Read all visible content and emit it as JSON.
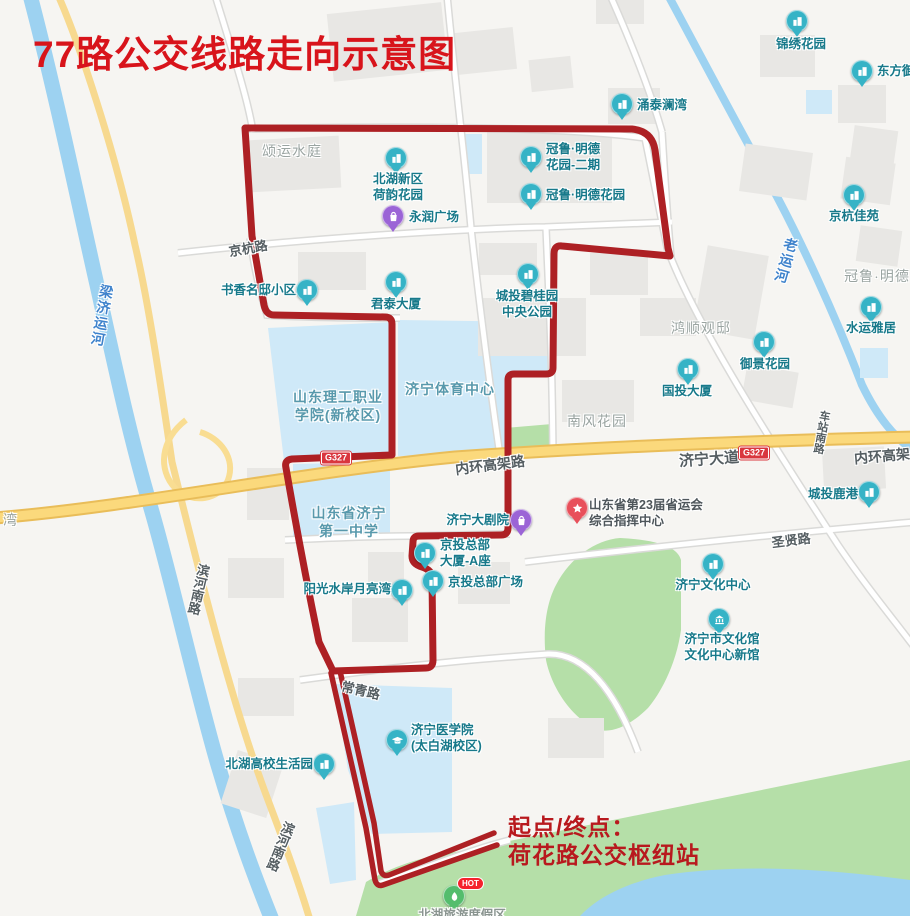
{
  "title": "77路公交线路走向示意图",
  "terminus": {
    "line1": "起点/终点：",
    "line2": "荷花路公交枢纽站"
  },
  "hot_badge": "HOT",
  "colors": {
    "route": "#ad2024",
    "title_red": "#d8141b",
    "terminus_red": "#b8191e",
    "poi_teal": "#36b3c6",
    "poi_purple": "#9b64d6",
    "poi_red": "#e8505b",
    "poi_green": "#54bd6d",
    "badge_red": "#d9363e",
    "water": "#9dd2f1",
    "campus_blue": "#cfe9f8",
    "park_green": "#b5dfa8",
    "road_yellow": "#fbd97c"
  },
  "badges": [
    {
      "text": "G327",
      "x": 336,
      "y": 458
    },
    {
      "text": "G327",
      "x": 754,
      "y": 453
    }
  ],
  "pois": [
    {
      "id": "jinxiu-huayuan",
      "glyph": "building",
      "color": "#36b3c6",
      "x": 797,
      "y": 21,
      "lx": 801,
      "ly": 36,
      "align": "center",
      "lines": [
        "锦绣花园"
      ]
    },
    {
      "id": "dongfang-yu",
      "glyph": "building",
      "color": "#36b3c6",
      "x": 862,
      "y": 71,
      "lx": 877,
      "ly": 63,
      "align": "left",
      "lines": [
        "东方御"
      ]
    },
    {
      "id": "yongtai-lanwan",
      "glyph": "building",
      "color": "#36b3c6",
      "x": 622,
      "y": 104,
      "lx": 637,
      "ly": 97,
      "align": "left",
      "lines": [
        "涌泰澜湾"
      ]
    },
    {
      "id": "beihu-heyun",
      "glyph": "building",
      "color": "#36b3c6",
      "x": 396,
      "y": 158,
      "lx": 398,
      "ly": 171,
      "align": "center",
      "lines": [
        "北湖新区",
        "荷韵花园"
      ]
    },
    {
      "id": "guanlu-mingde-2",
      "glyph": "building",
      "color": "#36b3c6",
      "x": 531,
      "y": 157,
      "lx": 546,
      "ly": 141,
      "align": "left",
      "lines": [
        "冠鲁·明德",
        "花园-二期"
      ]
    },
    {
      "id": "guanlu-mingde",
      "glyph": "building",
      "color": "#36b3c6",
      "x": 531,
      "y": 194,
      "lx": 546,
      "ly": 187,
      "align": "left",
      "lines": [
        "冠鲁·明德花园"
      ]
    },
    {
      "id": "yongrun-plaza",
      "glyph": "bag",
      "color": "#9b64d6",
      "x": 393,
      "y": 216,
      "lx": 409,
      "ly": 209,
      "align": "left",
      "lines": [
        "永润广场"
      ]
    },
    {
      "id": "shuxiang-mingdi",
      "glyph": "building",
      "color": "#36b3c6",
      "x": 307,
      "y": 290,
      "lx": 296,
      "ly": 282,
      "align": "right",
      "lines": [
        "书香名邸小区"
      ]
    },
    {
      "id": "juntai-dasha",
      "glyph": "building",
      "color": "#36b3c6",
      "x": 396,
      "y": 282,
      "lx": 396,
      "ly": 296,
      "align": "center",
      "lines": [
        "君泰大厦"
      ]
    },
    {
      "id": "chengtou-biguiyuan",
      "glyph": "building",
      "color": "#36b3c6",
      "x": 528,
      "y": 274,
      "lx": 527,
      "ly": 288,
      "align": "center",
      "lines": [
        "城投碧桂园",
        "中央公园"
      ]
    },
    {
      "id": "jinghang-jiayuan",
      "glyph": "building",
      "color": "#36b3c6",
      "x": 854,
      "y": 195,
      "lx": 854,
      "ly": 208,
      "align": "center",
      "lines": [
        "京杭佳苑"
      ]
    },
    {
      "id": "shuiyun-yaju",
      "glyph": "building",
      "color": "#36b3c6",
      "x": 871,
      "y": 307,
      "lx": 871,
      "ly": 320,
      "align": "center",
      "lines": [
        "水运雅居"
      ]
    },
    {
      "id": "yujing-huayuan",
      "glyph": "building",
      "color": "#36b3c6",
      "x": 764,
      "y": 342,
      "lx": 765,
      "ly": 356,
      "align": "center",
      "lines": [
        "御景花园"
      ]
    },
    {
      "id": "guotou-dasha",
      "glyph": "building",
      "color": "#36b3c6",
      "x": 688,
      "y": 369,
      "lx": 687,
      "ly": 383,
      "align": "center",
      "lines": [
        "国投大厦"
      ]
    },
    {
      "id": "chengtou-lugang",
      "glyph": "building",
      "color": "#36b3c6",
      "x": 869,
      "y": 492,
      "lx": 858,
      "ly": 486,
      "align": "right",
      "lines": [
        "城投鹿港"
      ]
    },
    {
      "id": "jining-dajuyuan",
      "glyph": "bag",
      "color": "#9b64d6",
      "x": 521,
      "y": 520,
      "lx": 509,
      "ly": 512,
      "align": "right",
      "lines": [
        "济宁大剧院"
      ]
    },
    {
      "id": "shengyunhui-zhihui",
      "glyph": "star",
      "color": "#e8505b",
      "x": 577,
      "y": 508,
      "lx": 589,
      "ly": 497,
      "align": "left",
      "lines": [
        "山东省第23届省运会",
        "综合指挥中心"
      ],
      "lcolor": "#4e565b"
    },
    {
      "id": "jingtou-dasha-a",
      "glyph": "building",
      "color": "#36b3c6",
      "x": 425,
      "y": 553,
      "lx": 440,
      "ly": 537,
      "align": "left",
      "lines": [
        "京投总部",
        "大厦-A座"
      ]
    },
    {
      "id": "jingtou-guangchang",
      "glyph": "building",
      "color": "#36b3c6",
      "x": 433,
      "y": 581,
      "lx": 448,
      "ly": 574,
      "align": "left",
      "lines": [
        "京投总部广场"
      ]
    },
    {
      "id": "jining-wenhua-zhongxin",
      "glyph": "building",
      "color": "#36b3c6",
      "x": 713,
      "y": 564,
      "lx": 713,
      "ly": 577,
      "align": "center",
      "lines": [
        "济宁文化中心"
      ]
    },
    {
      "id": "yangguang-shuian",
      "glyph": "building",
      "color": "#36b3c6",
      "x": 402,
      "y": 590,
      "lx": 391,
      "ly": 581,
      "align": "right",
      "lines": [
        "阳光水岸月亮湾"
      ]
    },
    {
      "id": "wenhuaguan-xinguan",
      "glyph": "museum",
      "color": "#36b3c6",
      "x": 719,
      "y": 619,
      "lx": 722,
      "ly": 631,
      "align": "center",
      "lines": [
        "济宁市文化馆",
        "文化中心新馆"
      ]
    },
    {
      "id": "jining-yixueyuan",
      "glyph": "cap",
      "color": "#36b3c6",
      "x": 397,
      "y": 740,
      "lx": 411,
      "ly": 722,
      "align": "left",
      "lines": [
        "济宁医学院",
        "(太白湖校区)"
      ]
    },
    {
      "id": "beihu-shenghuoyuan",
      "glyph": "building",
      "color": "#36b3c6",
      "x": 324,
      "y": 764,
      "lx": 313,
      "ly": 756,
      "align": "right",
      "lines": [
        "北湖高校生活园"
      ]
    },
    {
      "id": "beihu-dujiaqu",
      "glyph": "leaf",
      "color": "#54bd6d",
      "x": 454,
      "y": 896,
      "lx": 462,
      "ly": 907,
      "align": "center",
      "lines": [
        "北湖旅游度假区"
      ],
      "lcolor": "#8a9590",
      "hot": true
    }
  ],
  "campus_labels": [
    {
      "id": "ligong-xueyuan",
      "x": 338,
      "y": 388,
      "lines": [
        "山东理工职业",
        "学院(新校区)"
      ]
    },
    {
      "id": "tiyu-zhongxin",
      "x": 450,
      "y": 380,
      "lines": [
        "济宁体育中心"
      ]
    },
    {
      "id": "jining-yizhong",
      "x": 349,
      "y": 504,
      "lines": [
        "山东省济宁",
        "第一中学"
      ]
    }
  ],
  "area_labels": [
    {
      "id": "songyun-shuiting",
      "x": 292,
      "y": 141,
      "text": "颂运水庭"
    },
    {
      "id": "hongshun-guandi",
      "x": 701,
      "y": 318,
      "text": "鸿顺观邸"
    },
    {
      "id": "nanfeng-huayuan",
      "x": 597,
      "y": 411,
      "text": "南风花园"
    },
    {
      "id": "guanlu-mingde-r",
      "x": 877,
      "y": 266,
      "text": "冠鲁·明德"
    },
    {
      "id": "wan-partial",
      "x": 3,
      "y": 510,
      "text": "湾"
    }
  ],
  "road_labels": [
    {
      "id": "jinghang-lu",
      "x": 248,
      "y": 238,
      "rot": -10,
      "text": "京杭路",
      "size": 13,
      "vert": false
    },
    {
      "id": "neihuan-center",
      "x": 490,
      "y": 455,
      "rot": -7,
      "text": "内环高架路",
      "size": 14,
      "vert": false
    },
    {
      "id": "jining-dadao",
      "x": 709,
      "y": 448,
      "rot": -4,
      "text": "济宁大道",
      "size": 15,
      "vert": false
    },
    {
      "id": "neihuan-right",
      "x": 882,
      "y": 446,
      "rot": -5,
      "text": "内环高架",
      "size": 14,
      "vert": false
    },
    {
      "id": "shengxian-lu",
      "x": 791,
      "y": 530,
      "rot": -7,
      "text": "圣贤路",
      "size": 13,
      "vert": false
    },
    {
      "id": "changqing-lu",
      "x": 361,
      "y": 680,
      "rot": 13,
      "text": "常青路",
      "size": 13,
      "vert": false
    },
    {
      "id": "chezhan-nanlu",
      "x": 821,
      "y": 410,
      "rot": 10,
      "text": "车站南路",
      "size": 11,
      "vert": true
    },
    {
      "id": "binhe-nanlu-1",
      "x": 198,
      "y": 563,
      "rot": 13,
      "text": "滨河南路",
      "size": 13,
      "vert": true
    },
    {
      "id": "binhe-nanlu-2",
      "x": 280,
      "y": 820,
      "rot": 22,
      "text": "滨河南路",
      "size": 13,
      "vert": true
    }
  ],
  "river_labels": [
    {
      "id": "liangji-yunhe",
      "x": 102,
      "y": 284,
      "rot": 10,
      "text": "梁济运河"
    },
    {
      "id": "lao-yunhe",
      "x": 786,
      "y": 237,
      "rot": 16,
      "text": "老运河"
    }
  ]
}
